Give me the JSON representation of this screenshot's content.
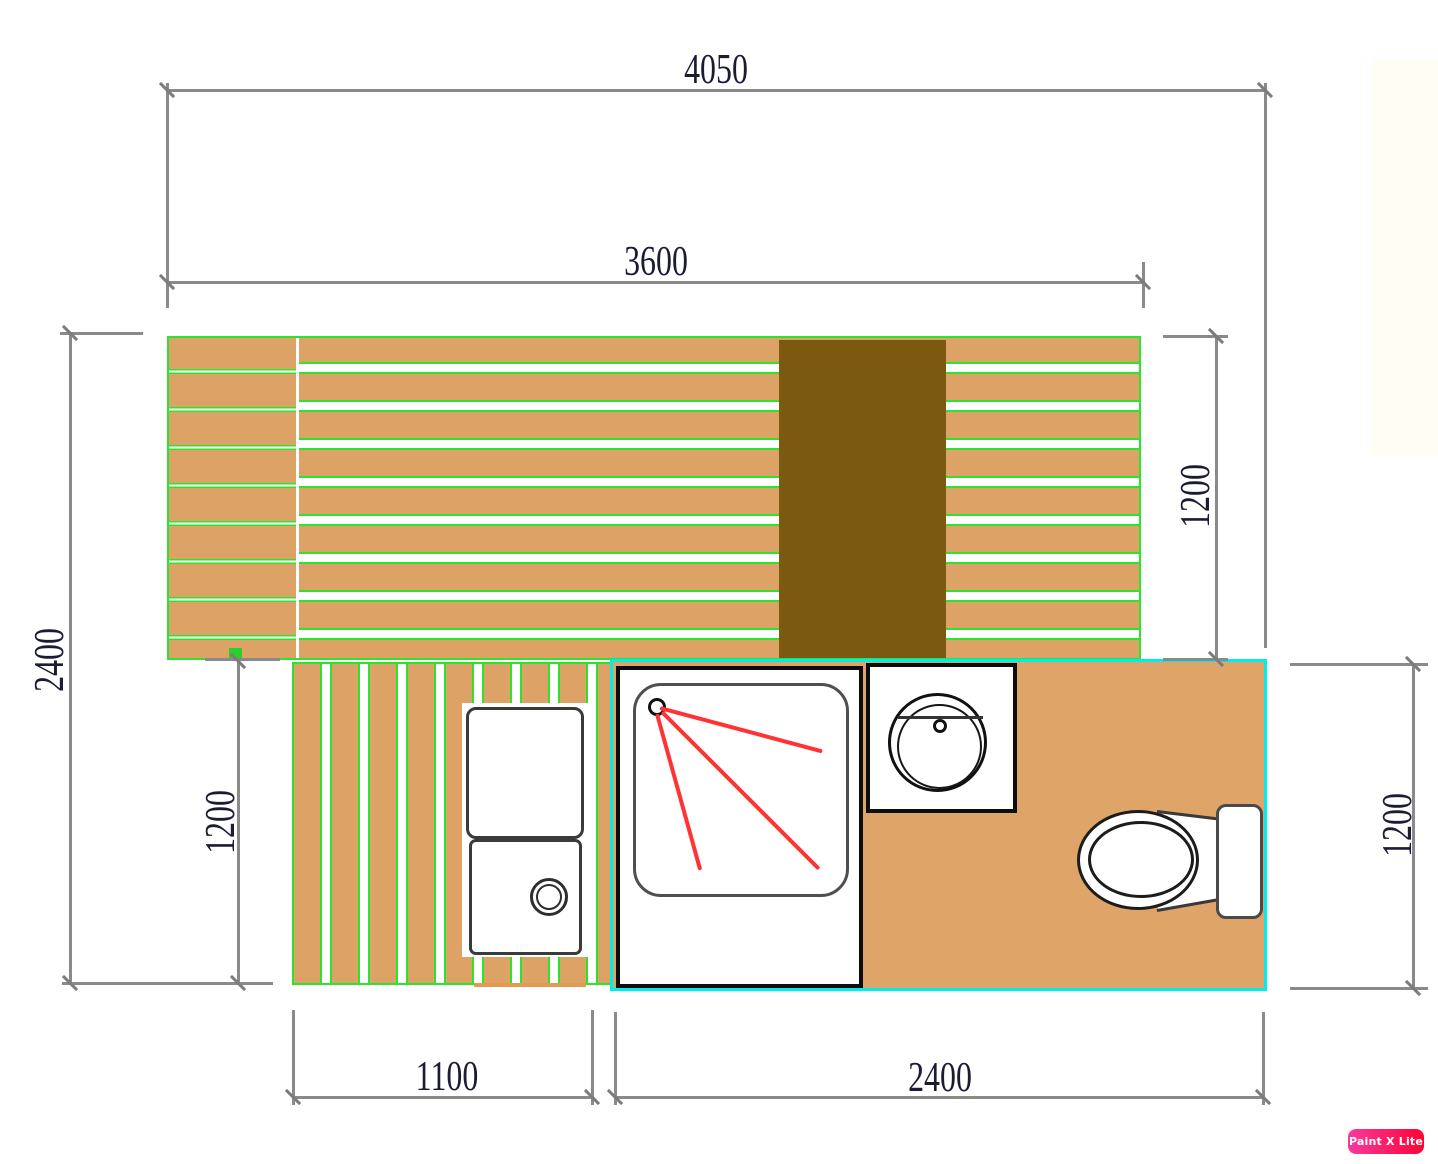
{
  "app": {
    "watermark": "Paint X Lite"
  },
  "palette": {
    "deck_tan": "#dda266",
    "plank_gap_green": "#2ee32e",
    "board_brown": "#7b5a10",
    "bathroom_border_cyan": "#00eded",
    "bathroom_floor_tan": "#dfa468",
    "dim_line_gray": "#8a8a8a",
    "dim_text_dark": "#1b1b33",
    "shower_spray_red": "#ff3333",
    "fixture_outline_black": "#0d0d0d",
    "watermark_pink": "#f8399f",
    "watermark_red": "#fe0434"
  },
  "dimensions": {
    "overall_width": {
      "label": "4050",
      "orientation": "horizontal"
    },
    "deck_width": {
      "label": "3600",
      "orientation": "horizontal"
    },
    "overall_depth": {
      "label": "2400",
      "orientation": "vertical"
    },
    "deck_depth_right": {
      "label": "1200",
      "orientation": "vertical"
    },
    "lower_deck_depth": {
      "label": "1200",
      "orientation": "vertical"
    },
    "lower_deck_width": {
      "label": "1100",
      "orientation": "horizontal"
    },
    "bathroom_width": {
      "label": "2400",
      "orientation": "horizontal"
    },
    "bathroom_depth": {
      "label": "1200",
      "orientation": "vertical"
    }
  }
}
